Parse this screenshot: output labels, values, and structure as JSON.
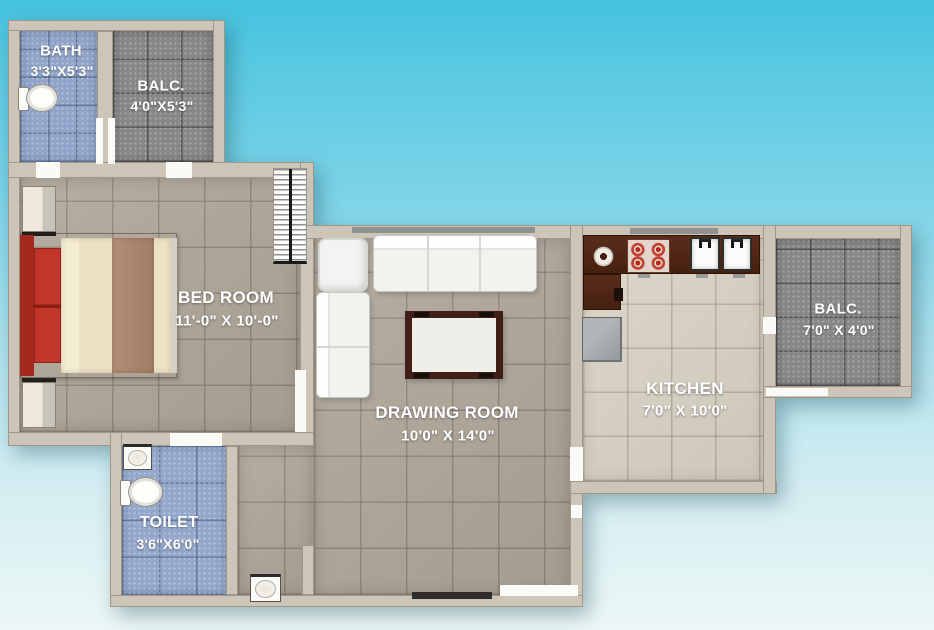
{
  "scene": {
    "type": "apartment-floor-plan",
    "style": "top-view 2D render on sky-blue gradient background"
  },
  "rooms": {
    "bath": {
      "label": "BATH",
      "dims": "3'3\"X5'3\""
    },
    "balcony_top": {
      "label": "BALC.",
      "dims": "4'0\"X5'3\""
    },
    "bedroom": {
      "label": "BED ROOM",
      "dims": "11'-0\" X 10'-0\""
    },
    "drawing_room": {
      "label": "DRAWING ROOM",
      "dims": "10'0\" X 14'0\""
    },
    "kitchen": {
      "label": "KITCHEN",
      "dims": "7'0\" X 10'0\""
    },
    "balcony_right": {
      "label": "BALC.",
      "dims": "7'0\" X 4'0\""
    },
    "toilet": {
      "label": "TOILET",
      "dims": "3'6\"X6'0\""
    }
  },
  "fixtures": [
    "toilet",
    "washbasin",
    "double-bed",
    "nightstand",
    "wardrobe",
    "sofa",
    "loveseat",
    "armchair",
    "coffee-table",
    "kitchen-counter",
    "gas-stove",
    "kitchen-sink",
    "refrigerator",
    "entrance-door"
  ],
  "colors": {
    "sky_top": "#44c2de",
    "sky_bottom": "#ecf7f6",
    "wall": "#cdc6b8",
    "floor_beige": "#b1a89b",
    "floor_kitchen_cream": "#d8d2c4",
    "floor_bath_blue": "#8fa4c8",
    "floor_balcony_gray": "#878787",
    "counter_brown": "#4e2516",
    "bed_red": "#c23529",
    "label_text": "#ffffff"
  }
}
